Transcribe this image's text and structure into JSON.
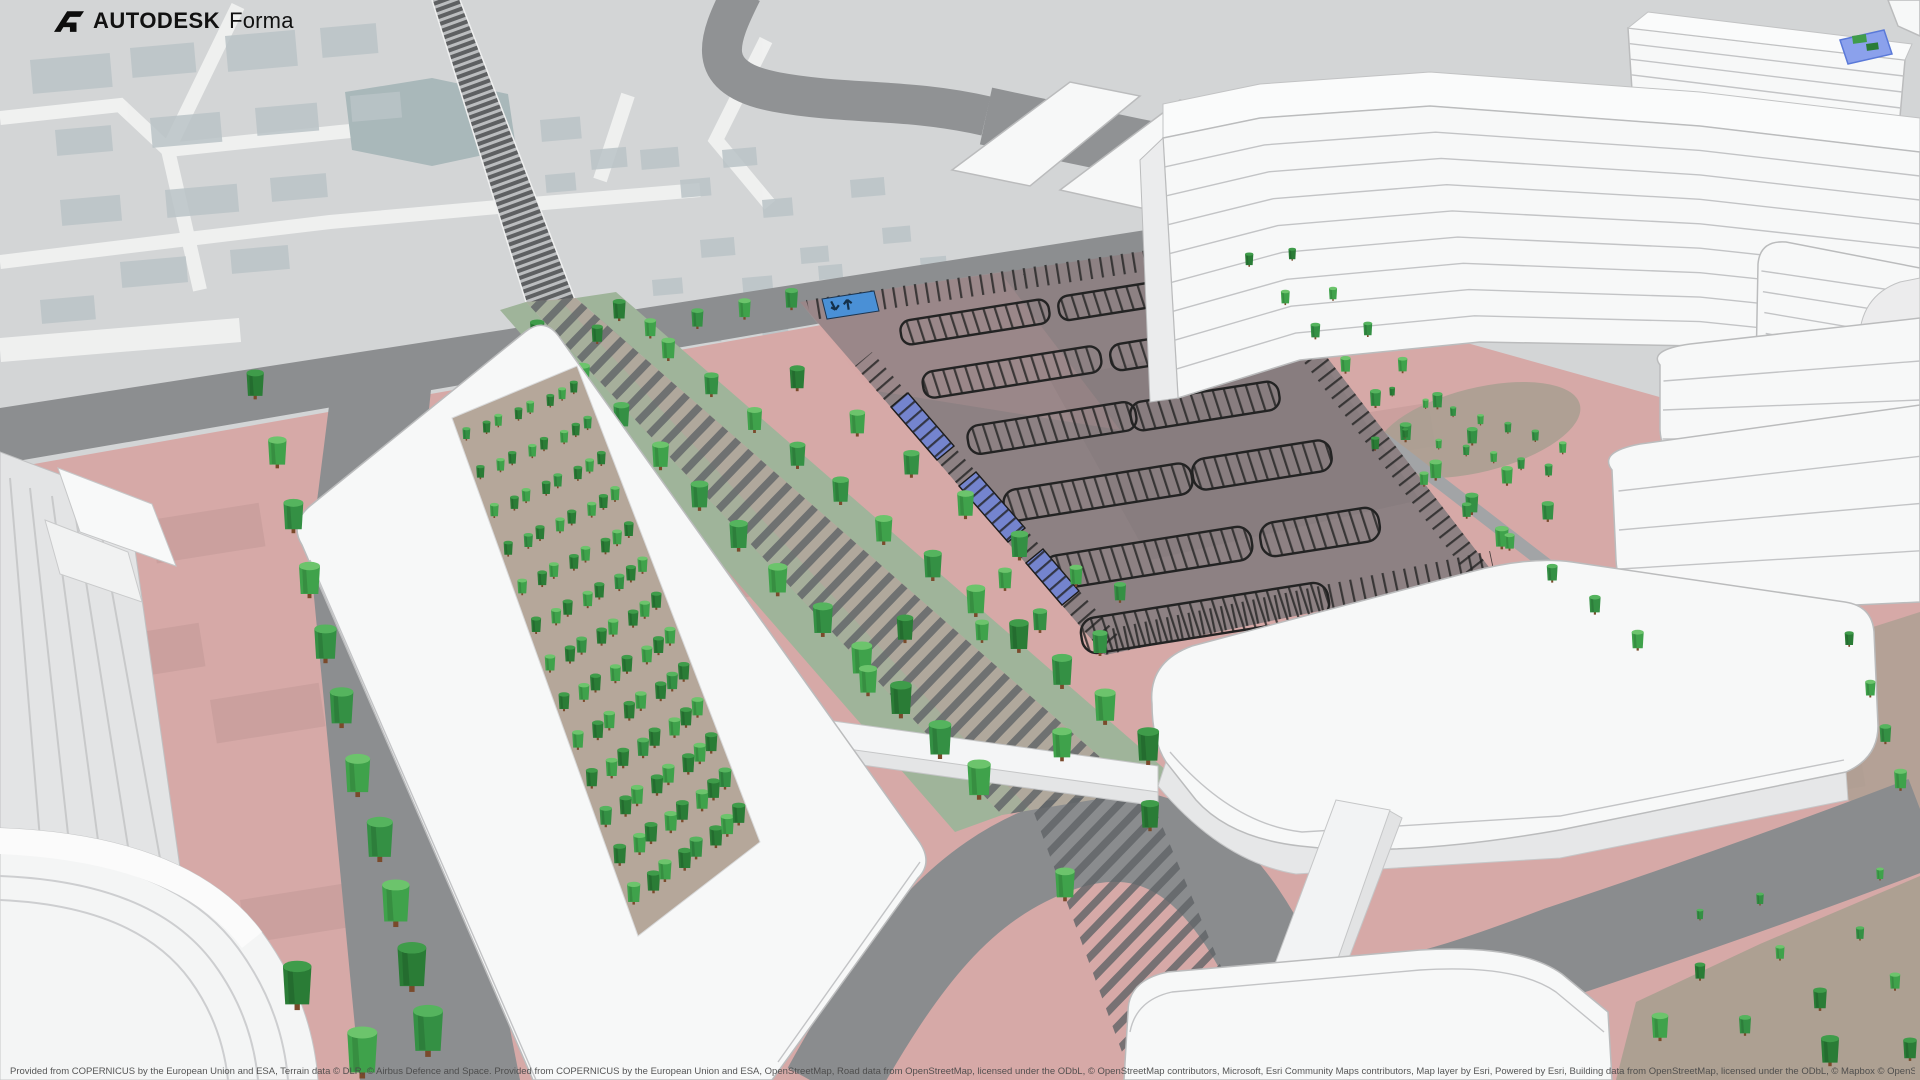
{
  "app": {
    "brand": "AUTODESK",
    "product": "Forma",
    "logo_icon": "autodesk-logo"
  },
  "attribution": {
    "part1": "Provided from COPERNICUS by the European Union and ESA, Terrain data © DLR, © Airbus Defence and Space. Provided from COPERNICUS by the European Union and ESA, OpenStreetMap, Road data from OpenStreetMap, licensed under the ODbL, © OpenStreetMap contributors, Microsoft, Esri Community Maps contributors, Map layer by Esri, Powered by Esri, Building data from OpenStreetMap, licensed under the ODbL, © Mapbox © OpenStreetMap contributors. ",
    "improve_link": "Improve this map",
    "part2": ", © Mapbox © OpenStreetMap contributors."
  },
  "parking": {
    "entrance_in_icon": "up-arrow",
    "entrance_out_icon": "down-left-arrow"
  },
  "colors": {
    "site_pink": "#d6a9a7",
    "road_gray": "#8c8e90",
    "map_ground": "#d3d5d6",
    "map_footprint": "#bac3c7",
    "water": "#a9b8ba",
    "railway": "#5e6062",
    "asphalt": "#8d8183",
    "stall_line": "#232323",
    "accessible_blue": "#7484ce",
    "entrance_blue": "#4a90d6",
    "tree_light_top": "#6cc46c",
    "tree_light_side": "#3fa24b",
    "tree_dark_top": "#3f9c4a",
    "tree_dark_side": "#2a7c36",
    "grass": "#9fb49a",
    "building_white": "#f6f7f7",
    "building_edge": "#bbbcbd",
    "tan": "#a89f90"
  }
}
